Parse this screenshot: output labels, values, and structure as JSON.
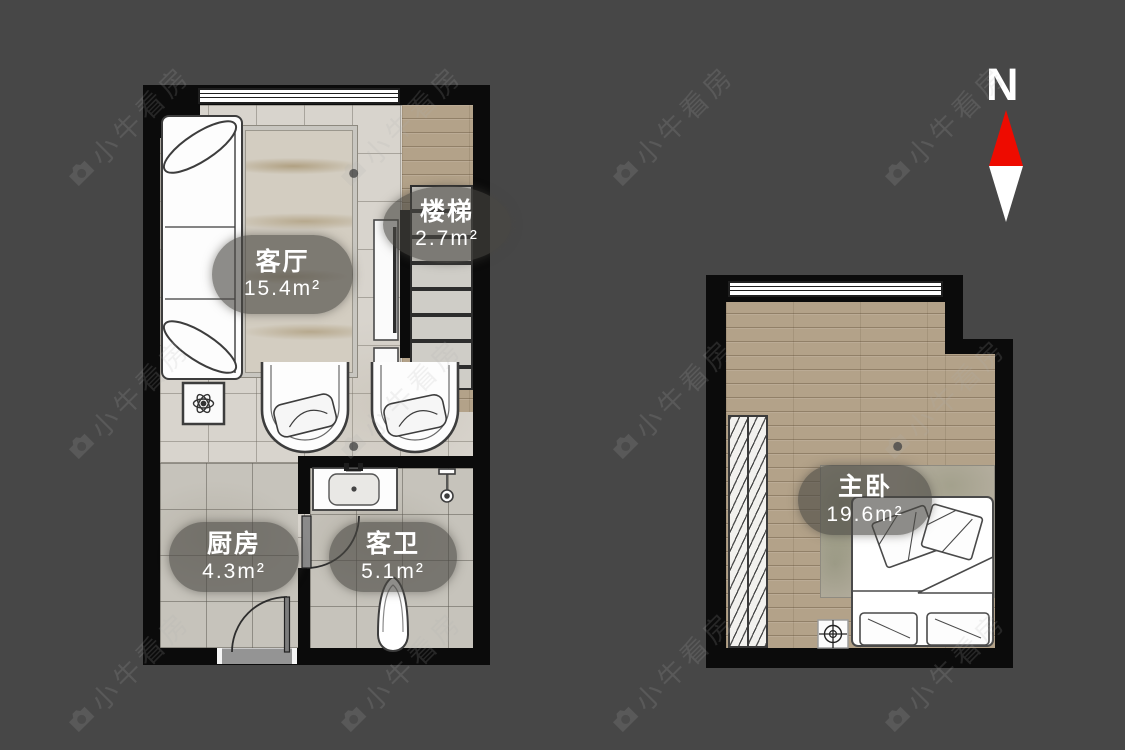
{
  "watermark": {
    "text": "小牛看房",
    "icon": "camera-icon"
  },
  "compass": {
    "north_label": "N",
    "arrow_top_color": "#ee0b00",
    "arrow_bottom_color": "#ffffff"
  },
  "floor1": {
    "rooms": [
      {
        "id": "living-room",
        "label": "客厅",
        "area": "15.4m²"
      },
      {
        "id": "stairs",
        "label": "楼梯",
        "area": "2.7m²"
      },
      {
        "id": "kitchen",
        "label": "厨房",
        "area": "4.3m²"
      },
      {
        "id": "guest-bathroom",
        "label": "客卫",
        "area": "5.1m²"
      }
    ]
  },
  "floor2": {
    "rooms": [
      {
        "id": "master-bedroom",
        "label": "主卧",
        "area": "19.6m²"
      }
    ]
  },
  "colors": {
    "background": "#474747",
    "wall": "#0b0b0b",
    "tile_floor": "#d8d4cd",
    "wood_floor": "#b3a289",
    "label_bubble": "rgba(73,71,66,0.62)",
    "compass_north": "#ee0b00"
  }
}
